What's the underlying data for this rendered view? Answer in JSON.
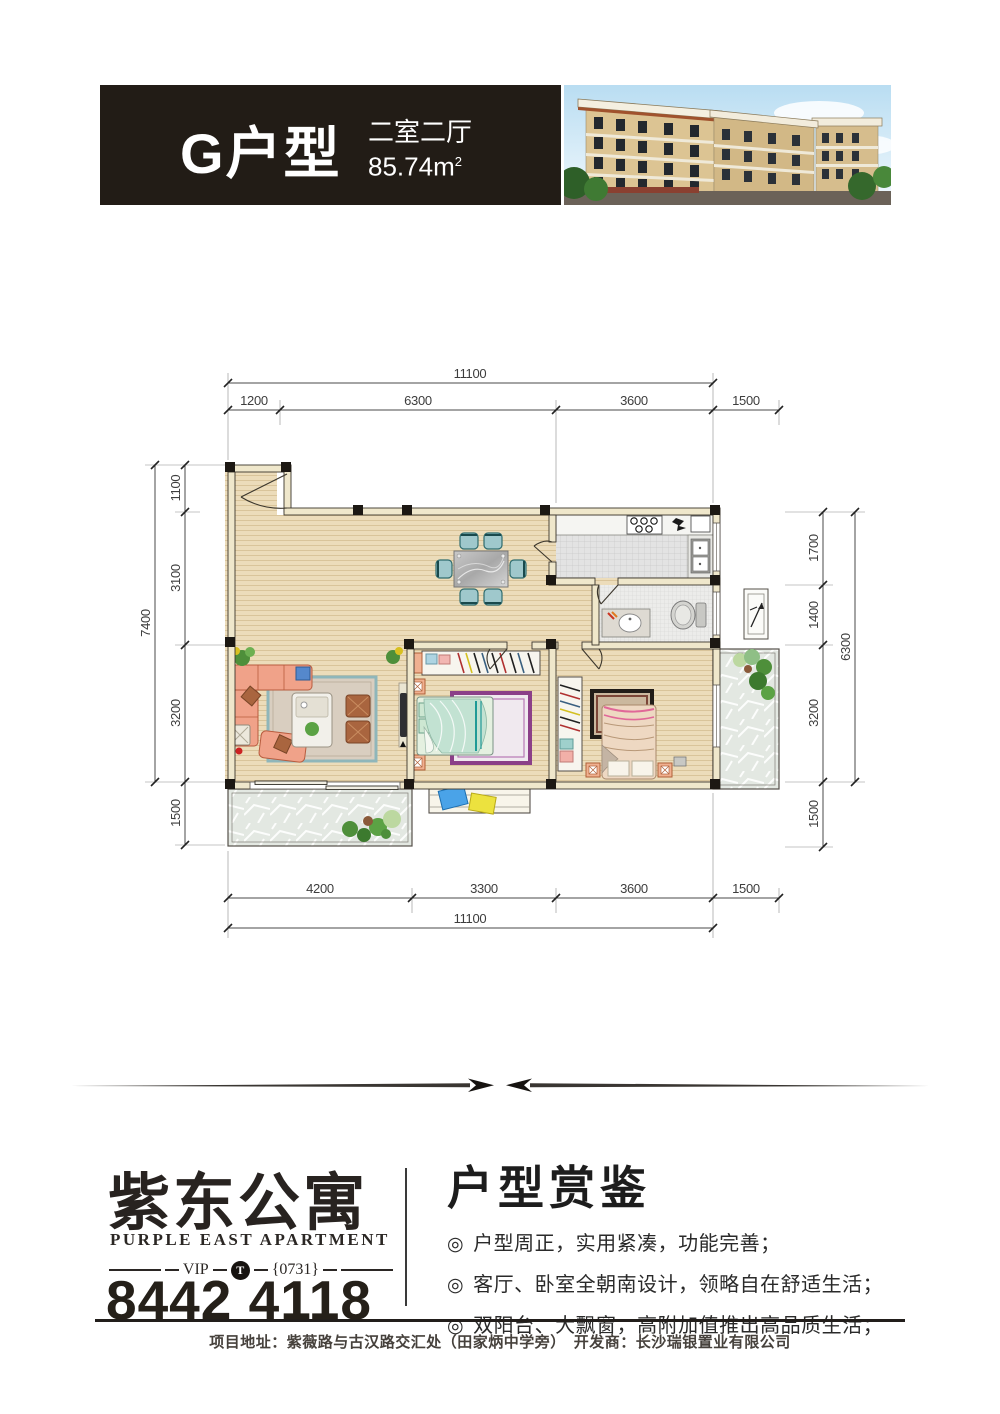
{
  "header": {
    "unit_name": "G户型",
    "unit_type": "二室二厅",
    "area_value": "85.74m",
    "area_sup": "2"
  },
  "plan": {
    "dims": {
      "top_total": "11100",
      "top": [
        "1200",
        "6300",
        "3600",
        "1500"
      ],
      "left_total": "7400",
      "left": [
        "1100",
        "3100",
        "3200",
        "1500"
      ],
      "right": [
        "1700",
        "1400",
        "3200",
        "1500"
      ],
      "right_total": "6300",
      "bottom": [
        "4200",
        "3300",
        "3600",
        "1500"
      ],
      "bottom_total": "11100"
    }
  },
  "brand": {
    "name_cn": "紫东公寓",
    "name_en": "PURPLE EAST APARTMENT",
    "vip_label": "VIP",
    "vip_t": "T",
    "vip_code": "{0731}",
    "phone": "8442 4118"
  },
  "features": {
    "title": "户型赏鉴",
    "bullet": "◎",
    "items": [
      "户型周正，实用紧凑，功能完善；",
      "客厅、卧室全朝南设计，领略自在舒适生活；",
      "双阳台、大飘窗，高附加值推出高品质生活；"
    ]
  },
  "footer": {
    "text": "项目地址：紫薇路与古汉路交汇处（田家炳中学旁）　开发商：长沙瑞银置业有限公司"
  },
  "colors": {
    "header_bg": "#221c16",
    "floor_wood": "#ecdcba",
    "wall_fill": "#efe7cb",
    "tile_gray": "#e3e3e3",
    "balcony_stone": "#e3e8e2",
    "sofa_salmon": "#f0a289",
    "chair_teal": "#9fc8cc",
    "rug_purple": "#8b3f88",
    "accent_red": "#cc2222"
  }
}
